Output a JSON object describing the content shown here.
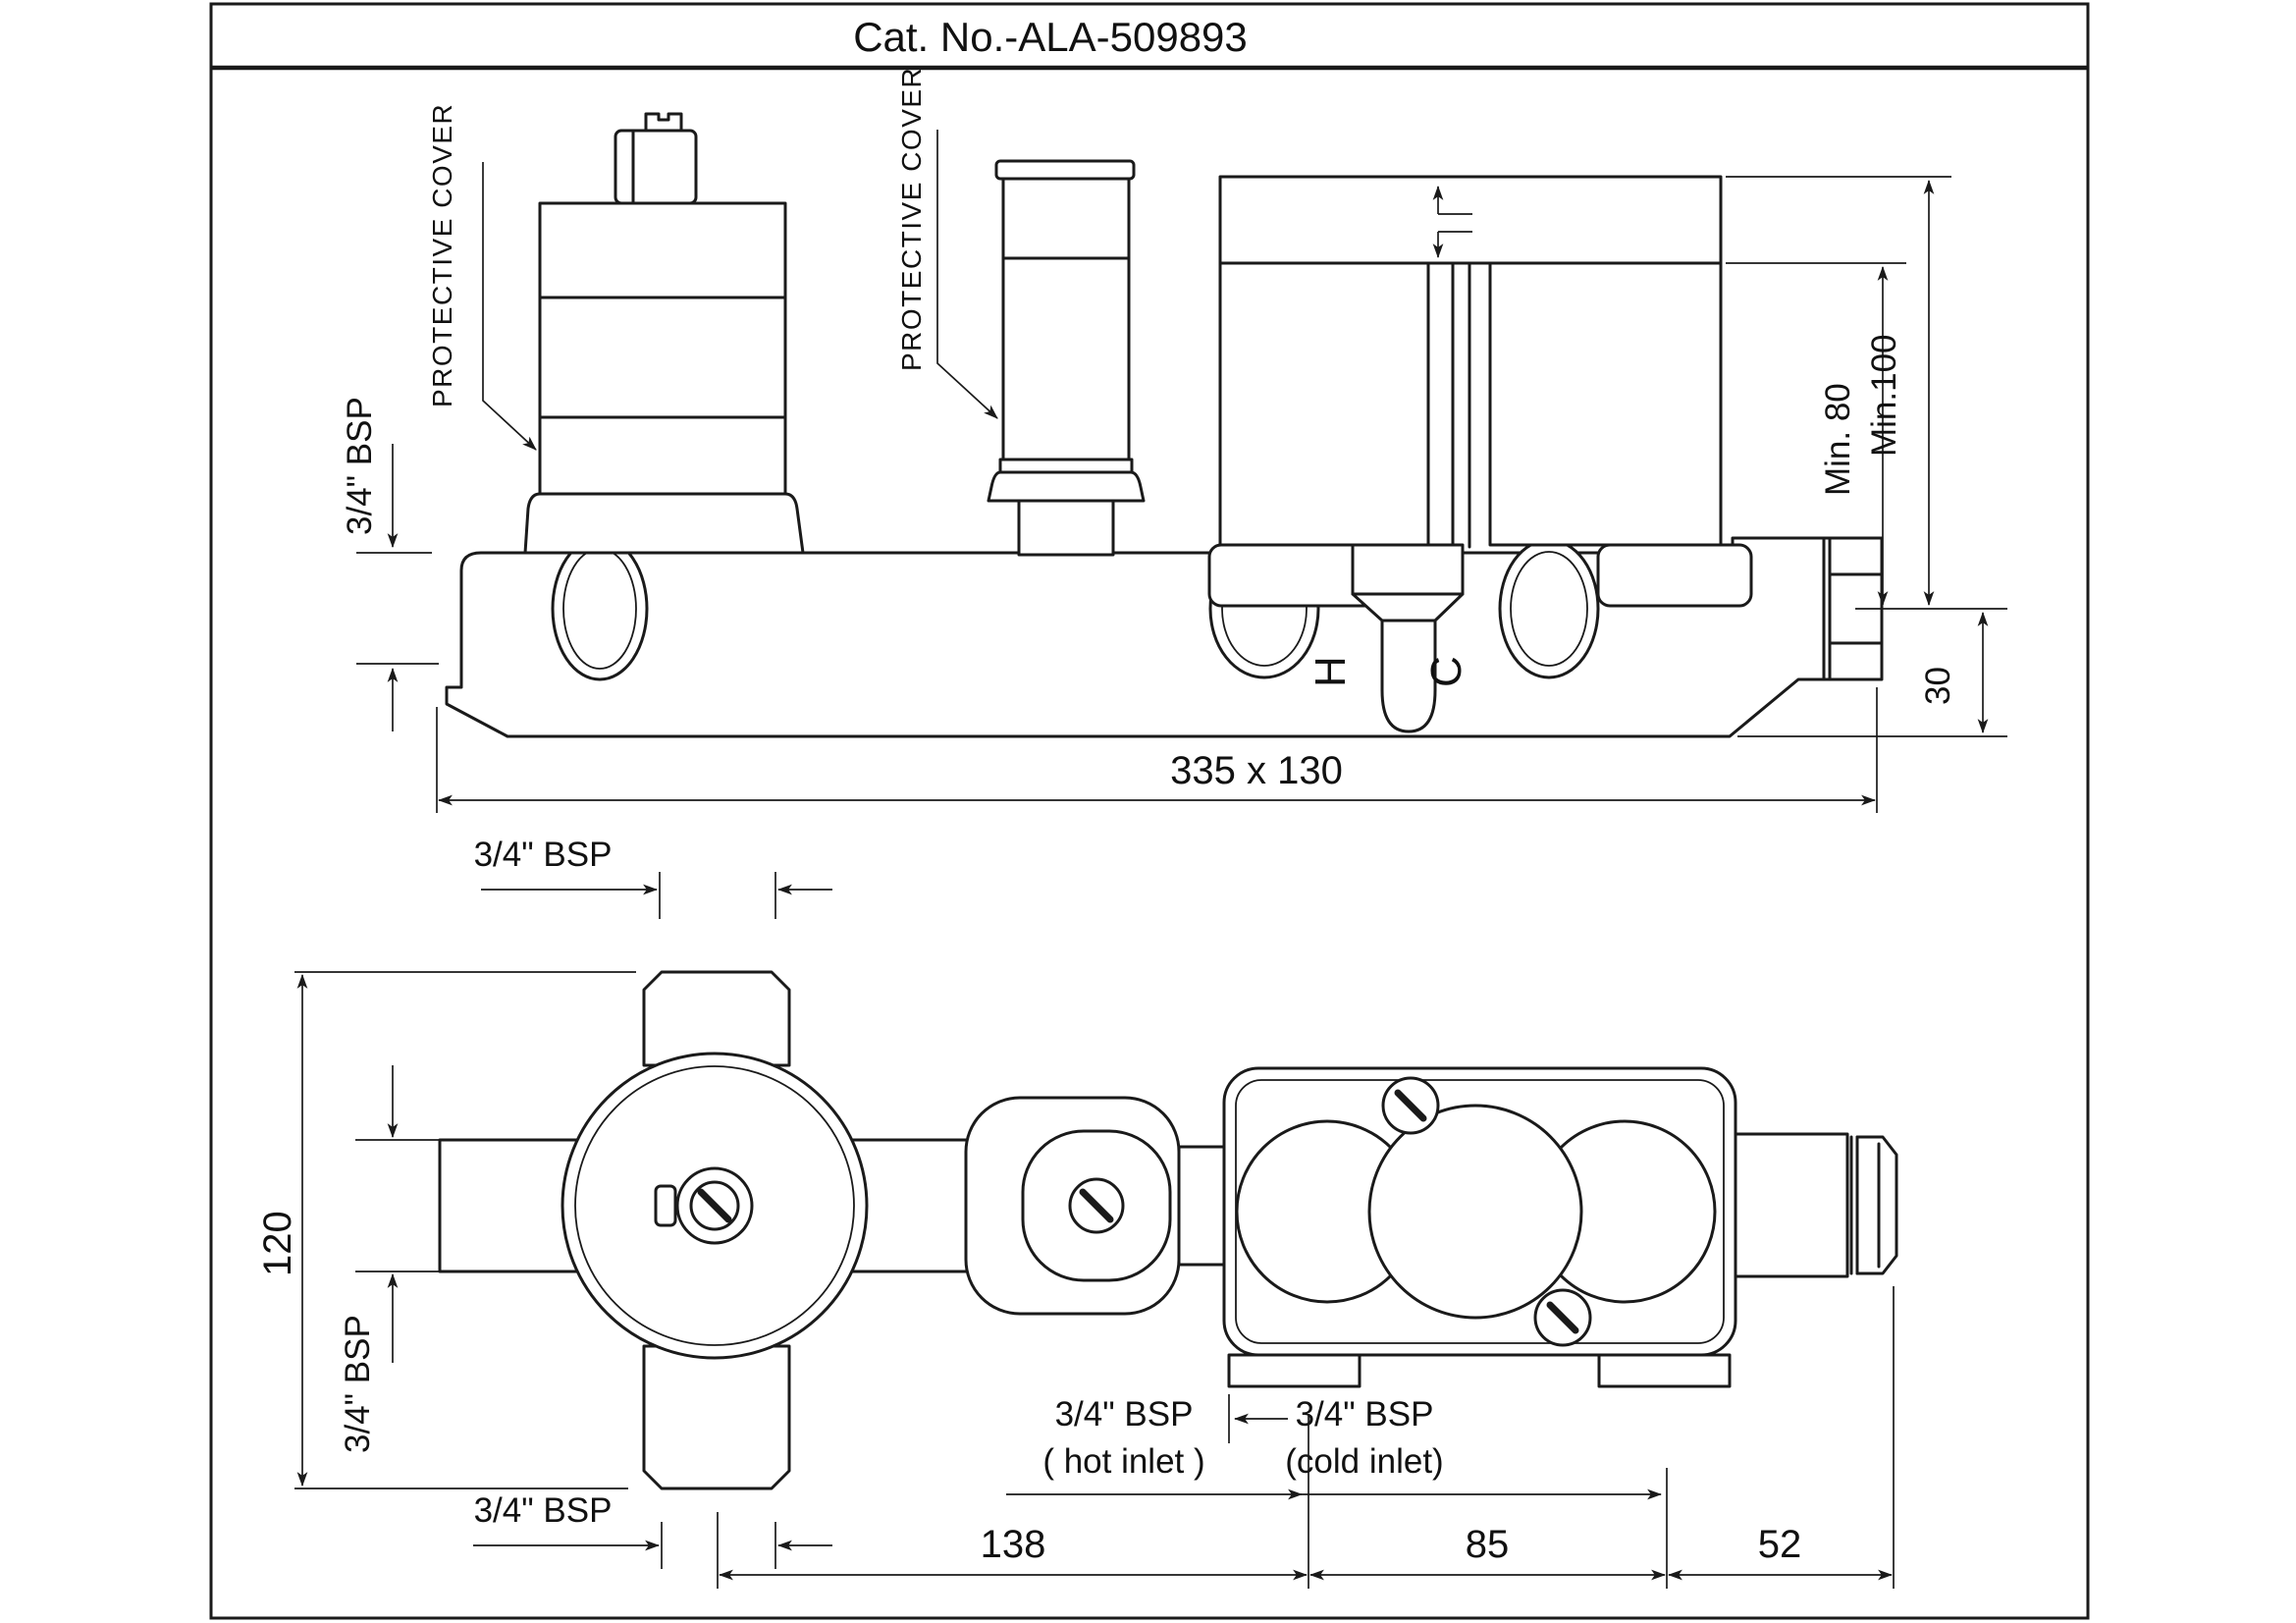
{
  "title": "Cat. No.-ALA-509893",
  "side_view": {
    "protective_cover_left": "PROTECTIVE COVER",
    "protective_cover_mid": "PROTECTIVE COVER",
    "bsp_inlet_left": "3/4\" BSP",
    "hot_marker": "H",
    "cold_marker": "C",
    "dim_min_80": "Min. 80",
    "dim_min_100": "Min.100",
    "dim_30": "30",
    "dim_overall": "335 x 130"
  },
  "plan_view": {
    "bsp_top_port": "3/4\" BSP",
    "bsp_side_port": "3/4\" BSP",
    "bsp_bottom_port": "3/4\" BSP",
    "hot_inlet_line1": "3/4\" BSP",
    "hot_inlet_line2": "( hot inlet )",
    "cold_inlet_line1": "3/4\" BSP",
    "cold_inlet_line2": "(cold inlet)",
    "dim_height": "120",
    "dim_span_1": "138",
    "dim_span_2": "85",
    "dim_span_3": "52"
  }
}
